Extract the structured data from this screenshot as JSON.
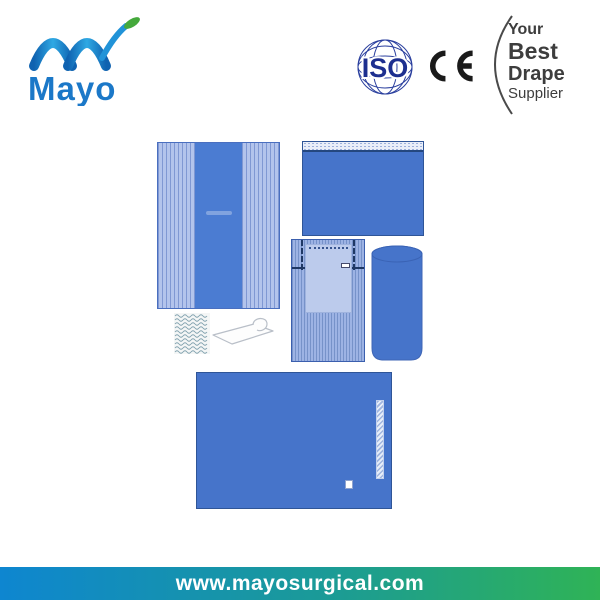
{
  "header": {
    "logo": {
      "text": "Mayo",
      "text_color": "#1b78c8",
      "arc_gradient_start": "#0f62b0",
      "arc_gradient_end": "#2fa9e4",
      "leaf_color": "#45a93c"
    },
    "iso_badge": {
      "label": "ISO",
      "color": "#1d2f8f"
    },
    "ce_mark": {
      "label": "CE",
      "color": "#1a1a1a"
    },
    "supplier_badge": {
      "lines": [
        "Your",
        "Best",
        "Drape",
        "Supplier"
      ],
      "text_color": "#3d3d3d",
      "arc_color": "#4a4a4a"
    }
  },
  "products": {
    "palette": {
      "drape_blue": "#4674ca",
      "drape_border_navy": "#2f5597",
      "stripe_field": "#b3c4ec",
      "stripe_line": "#5573be",
      "pocket_panel": "#bccbec",
      "stitch_navy": "#1f3864",
      "crepe_line": "#7fa0ad"
    },
    "items": [
      {
        "name": "side-drape-with-reinforced-center"
      },
      {
        "name": "adhesive-edge-drape"
      },
      {
        "name": "pocket-drape"
      },
      {
        "name": "rolled-table-cover"
      },
      {
        "name": "crepe-paper-sheet"
      },
      {
        "name": "adhesive-fixation-strap"
      },
      {
        "name": "back-table-cover-with-reinforcement-strip"
      }
    ]
  },
  "footer": {
    "website": "www.mayosurgical.com",
    "gradient_start": "#0e86d0",
    "gradient_end": "#2fb356",
    "text_color": "#ffffff"
  }
}
